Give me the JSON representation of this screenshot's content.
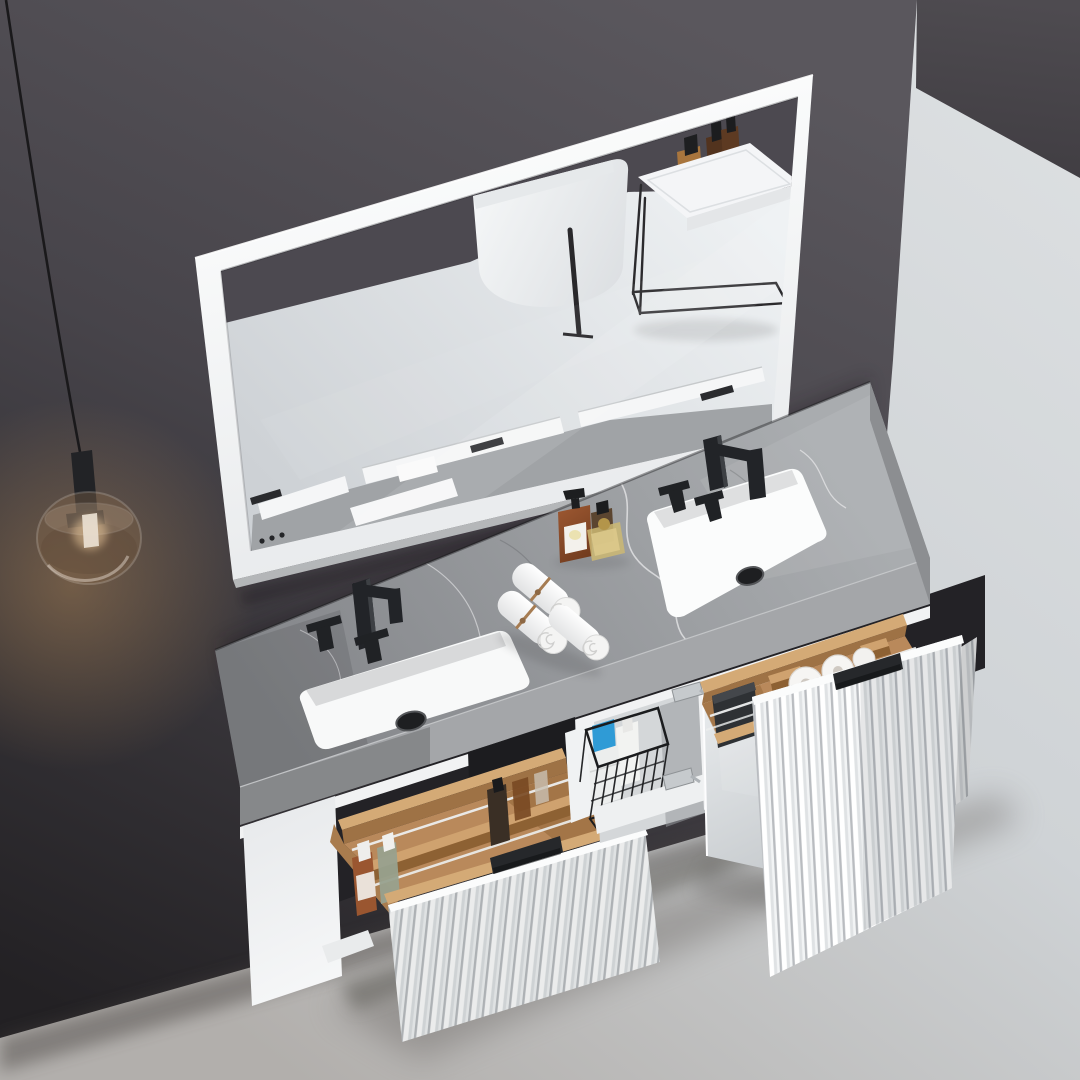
{
  "image": {
    "type": "3d-product-render",
    "subject": "Wall-hung double-sink bathroom vanity with white fluted drawer fronts, grey stone countertop, matte-black widespread faucets, white framed mirror and smoked-glass pendant lamp",
    "objects": {
      "mirror_reflection": "freestanding bathtub, black towel rod, black wire-frame side table with toiletries, vanity top",
      "open_drawers": 2,
      "open_doors": 1,
      "towel_rolls_on_counter": 3,
      "toilet_paper_rolls_in_drawer": 2,
      "wire_basket_in_cabinet": 1,
      "pendant_lamp": 1
    }
  },
  "palette": {
    "wall_top": "#5a575d",
    "wall_mid": "#47444a",
    "wall_dark": "#232124",
    "wall_right_top": "#4e4b50",
    "wall_right_bottom": "#403d42",
    "floor_light": "#dde0e2",
    "floor_mid": "#cfd3d6",
    "floor_dark": "#b2afac",
    "lamp_glow": "#cf9a5c",
    "lamp_cord": "#1a191b",
    "lamp_metal": "#222326",
    "lamp_glass_tint": "#7d6248",
    "lamp_glass_rim": "#e6ddd2",
    "mirror_frame_light": "#fcfdfd",
    "mirror_frame_dark": "#e7e9eb",
    "mirror_frame_edge": "#c9ccce",
    "glass_light": "#eef1f3",
    "glass_dark": "#cdd1d5",
    "reflection_wall": "#4c4950",
    "tub_light": "#f3f5f6",
    "tub_dark": "#dcdfe2",
    "table_white": "#f4f5f7",
    "table_face": "#e4e6e8",
    "metal_black": "#232427",
    "stone_top_light": "#a9acaf",
    "stone_top_dark": "#84868a",
    "stone_face_light": "#a4a6a9",
    "stone_face_dark": "#7d7f82",
    "stone_end": "#8c8e91",
    "vein_light": "#e9eaeb",
    "vein_dark": "#6e7073",
    "carcass_white": "#f1f2f3",
    "panel_light": "#e8eaec",
    "panel_bright": "#f6f7f8",
    "interior_dark": "#232226",
    "opening_dark": "#1c1c1f",
    "shelf_white": "#eef0f1",
    "partition_white": "#f0f2f3",
    "door_light": "#e9ecee",
    "door_dark": "#c9cdd0",
    "hinge_silver": "#c6cacd",
    "wood_top": "#d4aa76",
    "wood_face": "#9e7245",
    "wood_floor": "#b9895b",
    "wood_dark": "#8d6133",
    "wood_side": "#a97c4e",
    "flute_light": "#ffffff",
    "flute_mid": "#e9ebed",
    "flute_groove": "#b9bcc0",
    "handle_black": "#26282b",
    "sink_white": "#f8f9f9",
    "drain_black": "#1e1f21",
    "faucet_black": "#222428",
    "faucet_highlight": "#3d4044",
    "towel_white": "#ffffff",
    "towel_shade": "#dfe0e1",
    "twine": "#a67c52",
    "amber_light": "#9a5630",
    "amber_dark": "#6f3a1d",
    "label_white": "#f3f1ec",
    "bottle_brown": "#5b4530",
    "perfume_gold": "#cdb873",
    "perfume_cap": "#b3954a",
    "bottle_green": "#98a18e",
    "flask_dark": "#3a2f25",
    "amber_square": "#7a4a24",
    "clear_bottle": "#c9c1b3",
    "basket_wire": "#1b1c1e",
    "basket_blue": "#2f9bd6",
    "jug_white": "#f2f3f1",
    "towel_fold": "#eceeed",
    "paper_white": "#f6f5f3",
    "paper_hole": "#cfc9c2",
    "box_black": "#2e3134",
    "box_black_top": "#44474b",
    "shadow": "#141416"
  }
}
